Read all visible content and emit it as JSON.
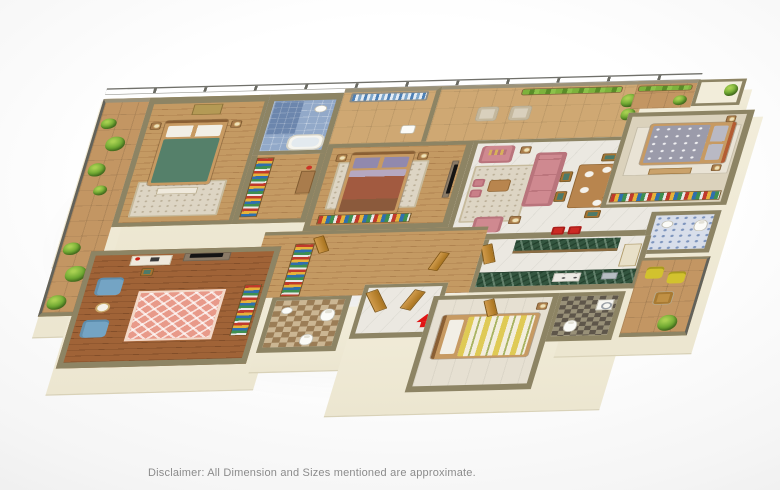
{
  "scene": {
    "type": "3d-isometric-apartment-floor-plan-render",
    "disclaimer": "Disclaimer: All Dimension and Sizes mentioned are approximate."
  },
  "palette": {
    "background": "#f6f6f6",
    "wall_top": "#8d8464",
    "wall_face_cream": "#f2edda",
    "wood_floor": "#c49a63",
    "wood_floor_dark": "#a06337",
    "marble_floor": "#ebe8e1",
    "balcony_tile": "#c39663",
    "plant_green": "#6fa832",
    "sofa_pink": "#cf8990",
    "bed_green": "#55806a",
    "bed_maroon": "#a25a40",
    "bed_gray": "#9b9baa",
    "bed_stripe_yellow": "#dfca55",
    "kitchen_counter_green": "#33553f",
    "armchair_blue": "#74a4c4",
    "patio_chair_yellow": "#d2c22e",
    "bath_tile_blue": "#92a9c9",
    "wardrobe_stripes": [
      "#c0392b",
      "#e6b23a",
      "#2f6fae",
      "#3f8f4f",
      "#e8e8e8"
    ],
    "entry_arrow_red": "#e01414",
    "door_wood": "#c58a3e"
  },
  "rooms": [
    {
      "name": "left-balcony",
      "features": [
        "glass-railing",
        "planters"
      ]
    },
    {
      "name": "bedroom-2",
      "features": [
        "double-bed-green",
        "wall-art",
        "rug",
        "bench"
      ]
    },
    {
      "name": "bathroom-1",
      "features": [
        "blue-tiles",
        "bathtub",
        "shower",
        "washbasin"
      ]
    },
    {
      "name": "dressing-area",
      "features": [
        "wardrobe-colorful",
        "dresser"
      ]
    },
    {
      "name": "utility-balcony",
      "features": [
        "clothes-drying-rack"
      ]
    },
    {
      "name": "master-bedroom",
      "features": [
        "double-bed-purple-maroon",
        "tv-unit",
        "wardrobe-colorful",
        "lamps"
      ]
    },
    {
      "name": "living-balcony",
      "features": [
        "wicker-chairs",
        "planters",
        "glass-railing"
      ]
    },
    {
      "name": "living-room",
      "features": [
        "pink-sofa",
        "pink-armchairs",
        "coffee-table",
        "pouffes",
        "rug",
        "floor-lamps"
      ]
    },
    {
      "name": "dining-area",
      "features": [
        "six-seat-dining-table",
        "plates",
        "red-bar-stools"
      ]
    },
    {
      "name": "kitchen",
      "features": [
        "green-marble-island",
        "green-marble-counter",
        "hob",
        "sink",
        "tall-cabinet"
      ]
    },
    {
      "name": "bedroom-3",
      "features": [
        "double-bed-gray",
        "wardrobe-colorful",
        "balcony-planters"
      ]
    },
    {
      "name": "bathroom-3",
      "features": [
        "blue-pattern-tiles",
        "toilet",
        "washbasin"
      ]
    },
    {
      "name": "corridor",
      "features": [
        "wardrobe-colorful",
        "wood-floor",
        "doors"
      ]
    },
    {
      "name": "study-room",
      "features": [
        "desk",
        "tv-console",
        "blue-armchairs",
        "round-table",
        "pink-diamond-rug",
        "wardrobe-colorful"
      ]
    },
    {
      "name": "bathroom-2",
      "features": [
        "checkered-floor",
        "toilets",
        "washbasin"
      ]
    },
    {
      "name": "entrance-foyer",
      "features": [
        "wooden-entry-doors",
        "red-entry-arrow"
      ]
    },
    {
      "name": "utility-bedroom",
      "features": [
        "single-bed-striped"
      ]
    },
    {
      "name": "utility-bathroom",
      "features": [
        "dark-checkered-floor",
        "washer",
        "toilet"
      ]
    },
    {
      "name": "rear-balcony",
      "features": [
        "yellow-chairs",
        "wicker-chair",
        "plant",
        "glass-railing"
      ]
    }
  ]
}
